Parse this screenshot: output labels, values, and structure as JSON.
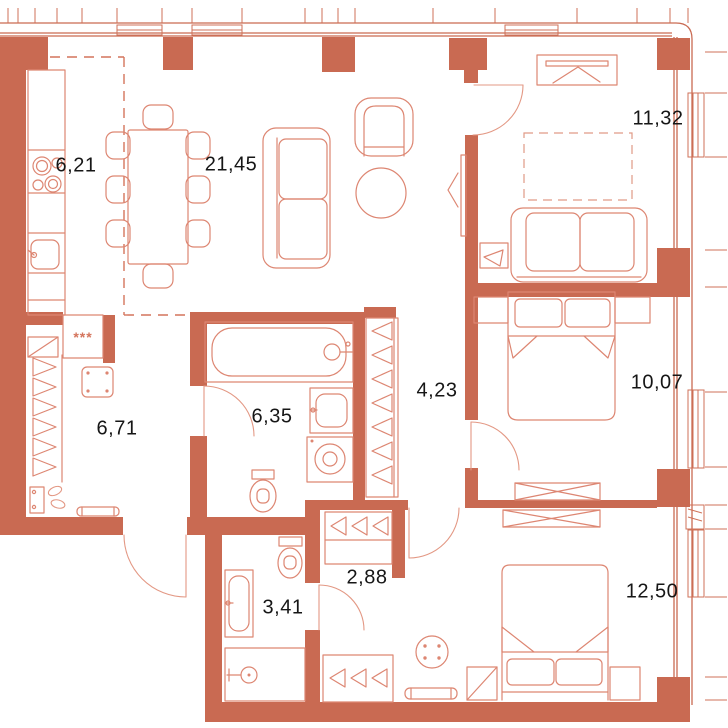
{
  "plan": {
    "type": "apartment-floor-plan",
    "colors": {
      "wall": "#c96a52",
      "furniture_line": "#dd8672",
      "zone_dash_line": "#d4745c",
      "label_text": "#161616",
      "background": "#ffffff"
    },
    "rooms": [
      {
        "name": "kitchen",
        "area": "6,21"
      },
      {
        "name": "living-dining",
        "area": "21,45"
      },
      {
        "name": "bedroom-top-right",
        "area": "11,32"
      },
      {
        "name": "dressing-entrance",
        "area": "6,71"
      },
      {
        "name": "bathroom",
        "area": "6,35"
      },
      {
        "name": "hallway",
        "area": "4,23"
      },
      {
        "name": "bedroom-right",
        "area": "10,07"
      },
      {
        "name": "shower-room",
        "area": "3,41"
      },
      {
        "name": "hall",
        "area": "2,88"
      },
      {
        "name": "bedroom-bottom",
        "area": "12,50"
      }
    ],
    "symbols": {
      "utility_box": "***"
    }
  }
}
